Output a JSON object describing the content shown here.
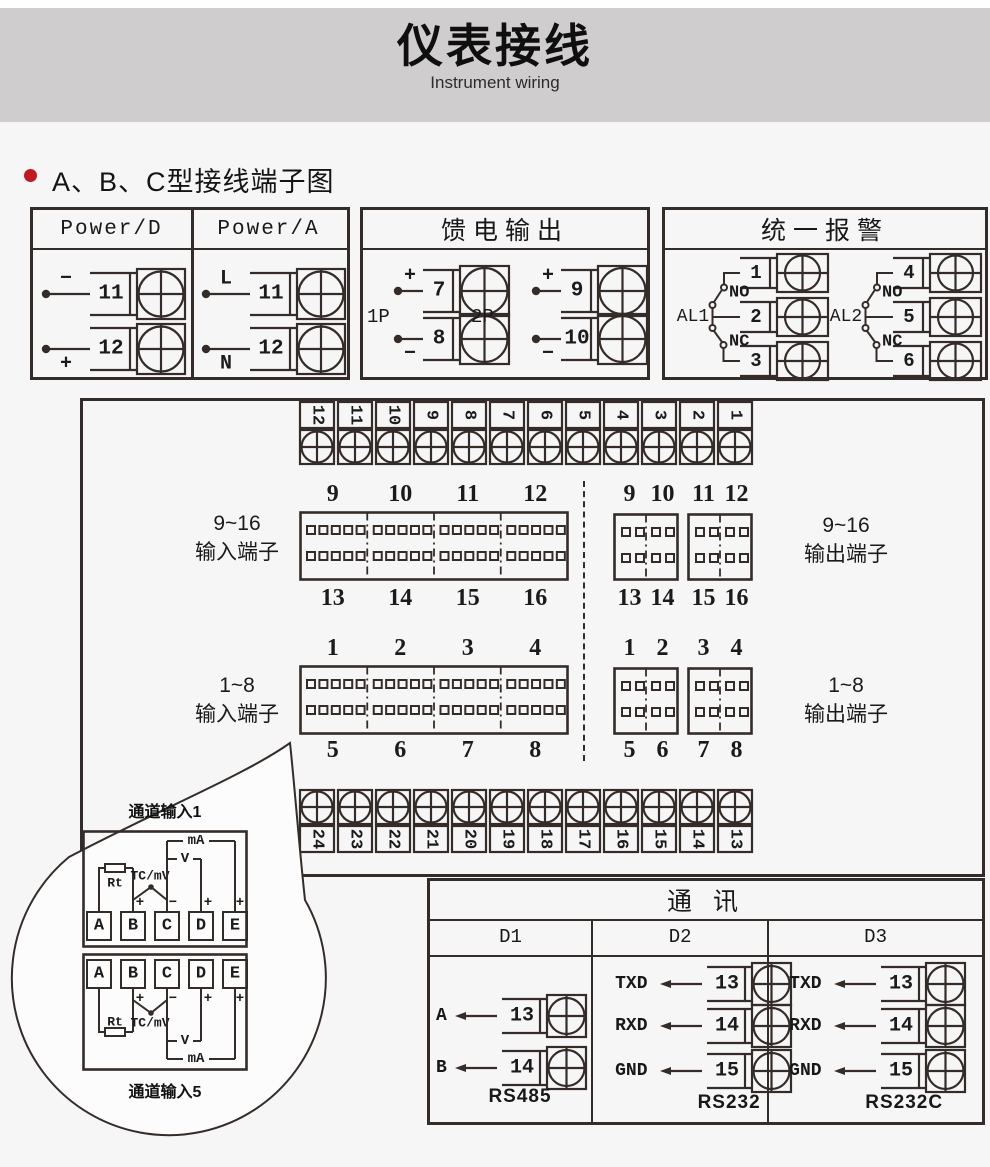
{
  "header": {
    "title": "仪表接线",
    "subtitle": "Instrument wiring"
  },
  "section": {
    "title": "A、B、C型接线端子图"
  },
  "power_box": {
    "columns": [
      {
        "title": "Power/D",
        "terminals": [
          {
            "sign": "−",
            "pos": "above",
            "num": "11"
          },
          {
            "sign": "+",
            "pos": "below",
            "num": "12"
          }
        ]
      },
      {
        "title": "Power/A",
        "terminals": [
          {
            "sign": "L",
            "pos": "above",
            "num": "11"
          },
          {
            "sign": "N",
            "pos": "below",
            "num": "12"
          }
        ]
      }
    ]
  },
  "feed_box": {
    "title": "馈电输出",
    "groups": [
      {
        "label": "1P",
        "terminals": [
          {
            "sign": "+",
            "pos": "above",
            "num": "7"
          },
          {
            "sign": "−",
            "pos": "below",
            "num": "8"
          }
        ]
      },
      {
        "label": "2P",
        "terminals": [
          {
            "sign": "+",
            "pos": "above",
            "num": "9"
          },
          {
            "sign": "−",
            "pos": "below",
            "num": "10"
          }
        ]
      }
    ]
  },
  "alarm_box": {
    "title": "统一报警",
    "groups": [
      {
        "label": "AL1",
        "no": "NO",
        "nc": "NC",
        "terminals": [
          "1",
          "2",
          "3"
        ]
      },
      {
        "label": "AL2",
        "no": "NO",
        "nc": "NC",
        "terminals": [
          "4",
          "5",
          "6"
        ]
      }
    ]
  },
  "main_board": {
    "top_strip": [
      "12",
      "11",
      "10",
      "9",
      "8",
      "7",
      "6",
      "5",
      "4",
      "3",
      "2",
      "1"
    ],
    "bottom_strip": [
      "24",
      "23",
      "22",
      "21",
      "20",
      "19",
      "18",
      "17",
      "16",
      "15",
      "14",
      "13"
    ],
    "input_blocks": [
      {
        "side_label_1": "9~16",
        "side_label_2": "输入端子",
        "top_labels": [
          "9",
          "10",
          "11",
          "12"
        ],
        "bottom_labels": [
          "13",
          "14",
          "15",
          "16"
        ]
      },
      {
        "side_label_1": "1~8",
        "side_label_2": "输入端子",
        "top_labels": [
          "1",
          "2",
          "3",
          "4"
        ],
        "bottom_labels": [
          "5",
          "6",
          "7",
          "8"
        ]
      }
    ],
    "output_blocks": [
      {
        "side_label_1": "9~16",
        "side_label_2": "输出端子",
        "top_labels": [
          "9",
          "10",
          "11",
          "12"
        ],
        "bottom_labels": [
          "13",
          "14",
          "15",
          "16"
        ]
      },
      {
        "side_label_1": "1~8",
        "side_label_2": "输出端子",
        "top_labels": [
          "1",
          "2",
          "3",
          "4"
        ],
        "bottom_labels": [
          "5",
          "6",
          "7",
          "8"
        ]
      }
    ]
  },
  "callout": {
    "channels": [
      {
        "label": "通道输入1",
        "terminals": [
          "A",
          "B",
          "C",
          "D",
          "E"
        ],
        "rt": "Rt",
        "tc": "TC/mV",
        "v": "V",
        "ma": "mA",
        "plus": "+",
        "minus": "−"
      },
      {
        "label": "通道输入5",
        "terminals": [
          "A",
          "B",
          "C",
          "D",
          "E"
        ],
        "rt": "Rt",
        "tc": "TC/mV",
        "v": "V",
        "ma": "mA",
        "plus": "+",
        "minus": "−"
      }
    ]
  },
  "comm_box": {
    "title": "通  讯",
    "columns": [
      {
        "header": "D1",
        "rows": [
          {
            "label": "A",
            "num": "13"
          },
          {
            "label": "B",
            "num": "14"
          }
        ],
        "footer": "RS485"
      },
      {
        "header": "D2",
        "rows": [
          {
            "label": "TXD",
            "num": "13"
          },
          {
            "label": "RXD",
            "num": "14"
          },
          {
            "label": "GND",
            "num": "15"
          }
        ],
        "footer": "RS232"
      },
      {
        "header": "D3",
        "rows": [
          {
            "label": "TXD",
            "num": "13"
          },
          {
            "label": "RXD",
            "num": "14"
          },
          {
            "label": "GND",
            "num": "15"
          }
        ],
        "footer": "RS232C"
      }
    ]
  },
  "colors": {
    "line": "#342c29",
    "banner": "#cfcdce",
    "page": "#f7f6f6",
    "bullet": "#c01920"
  }
}
